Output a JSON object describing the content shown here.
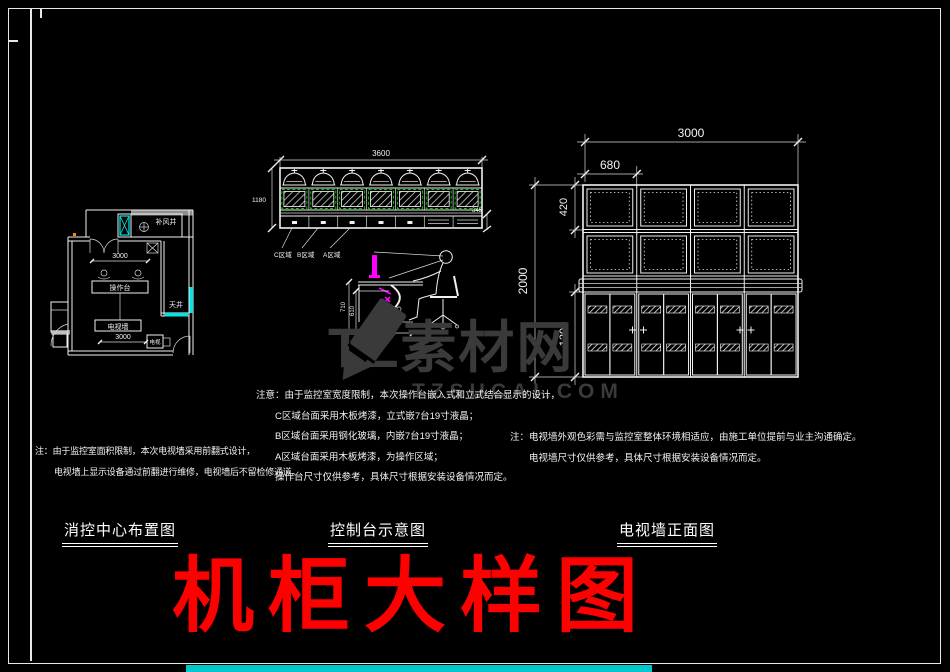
{
  "watermark": {
    "brand": "TZ素材网",
    "domain": "TZSUCAI.COM"
  },
  "main_title": "机柜大样图",
  "colors": {
    "line_white": "#f0f0f0",
    "accent_cyan": "#00e5e5",
    "accent_green": "#00d400",
    "accent_magenta": "#ff00ff",
    "title_red": "#ff0000",
    "watermark_gray": "#3a3a3a"
  },
  "floor_plan": {
    "title": "消控中心布置图",
    "dim_top": "3000",
    "dim_bottom": "3000",
    "label_console": "操作台",
    "label_tv_wall": "电视墙",
    "label_tv": "电视",
    "label_shaft": "天井",
    "label_air_shaft": "补风井",
    "note1": "注：由于监控室面积限制，本次电视墙采用前翻式设计，",
    "note2": "电视墙上显示设备通过前翻进行维修，电视墙后不留检修通道。"
  },
  "console": {
    "title": "控制台示意图",
    "dim_width": "3600",
    "dim_height": "1180",
    "dim_drawer": "345",
    "zone_c": "C区域",
    "zone_b": "B区域",
    "zone_a": "A区域",
    "side_dim_h1": "710",
    "side_dim_h2": "610",
    "side_dim_w": "650",
    "note_title": "注意：由于监控室宽度限制，本次操作台嵌入式和立式结合显示的设计，",
    "note_c": "C区域台面采用木板烤漆，立式嵌7台19寸液晶；",
    "note_b": "B区域台面采用钢化玻璃，内嵌7台19寸液晶；",
    "note_a": "A区域台面采用木板烤漆，为操作区域；",
    "note_end": "操作台尺寸仅供参考，具体尺寸根据安装设备情况而定。"
  },
  "tv_wall": {
    "title": "电视墙正面图",
    "dim_total_width": "3000",
    "dim_panel_width": "680",
    "dim_row_height": "420",
    "dim_total_height": "2000",
    "dim_cabinet_height": "1200",
    "note1": "注：电视墙外观色彩需与监控室整体环境相适应，由施工单位提前与业主沟通确定。",
    "note2": "电视墙尺寸仅供参考，具体尺寸根据安装设备情况而定。"
  }
}
